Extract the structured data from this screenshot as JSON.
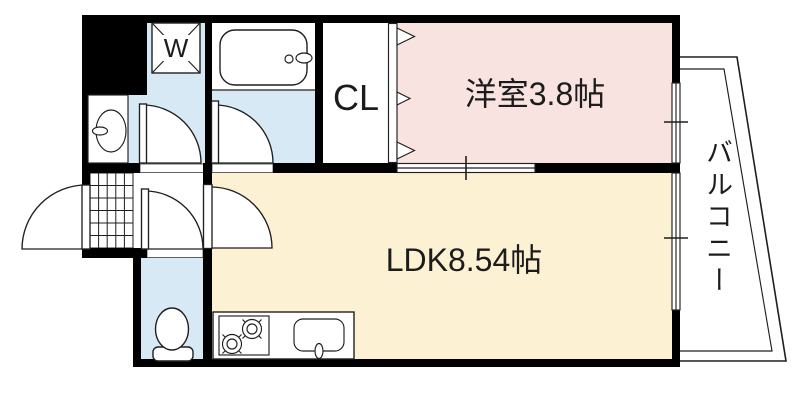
{
  "floor_plan": {
    "title": "1LDK apartment floor plan",
    "labels": {
      "washing_machine": "W",
      "closet": "CL",
      "western_room": "洋室3.8帖",
      "ldk": "LDK8.54帖",
      "balcony": "バルコニー"
    },
    "rooms": [
      {
        "name": "western-room",
        "label": "洋室3.8帖"
      },
      {
        "name": "ldk",
        "label": "LDK8.54帖"
      },
      {
        "name": "closet",
        "label": "CL"
      },
      {
        "name": "balcony",
        "label": "バルコニー"
      },
      {
        "name": "washing-machine-place",
        "label": "W"
      }
    ],
    "fixtures": [
      "bathtub",
      "washbasin",
      "toilet",
      "gas-stove",
      "kitchen-sink",
      "entrance-tile",
      "washing-machine-place",
      "pipe-space"
    ],
    "colors": {
      "wall": "#000000",
      "line": "#1f1f1f",
      "floor_pink": "#f8e3e0",
      "floor_cream": "#fdf1d4",
      "floor_blue": "#d8e9f6"
    }
  }
}
